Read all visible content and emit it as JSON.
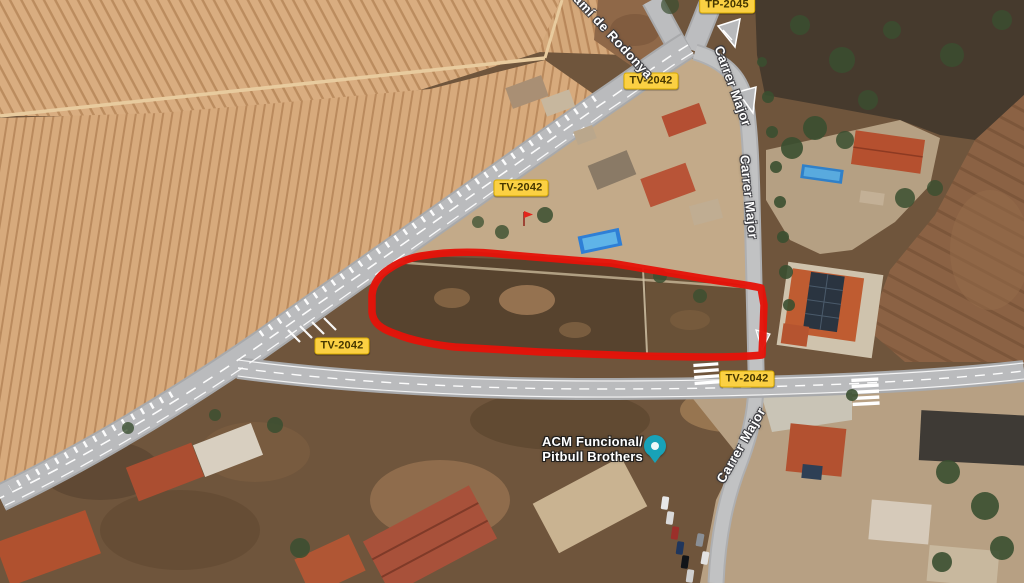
{
  "map": {
    "view": "satellite",
    "route_badges": [
      {
        "id": "tp-2045",
        "label": "TP-2045"
      },
      {
        "id": "tv-2042-top",
        "label": "TV-2042"
      },
      {
        "id": "tv-2042-mid",
        "label": "TV-2042"
      },
      {
        "id": "tv-2042-junction",
        "label": "TV-2042"
      },
      {
        "id": "tv-2042-east",
        "label": "TV-2042"
      }
    ],
    "road_labels": [
      {
        "id": "cami-de-rodonya",
        "label": "Camí de Rodonya"
      },
      {
        "id": "carrer-major-upper",
        "label": "Carrer Major"
      },
      {
        "id": "carrer-major-middle",
        "label": "Carrer Major"
      },
      {
        "id": "carrer-major-lower",
        "label": "Carrer Major"
      }
    ],
    "place": {
      "line1": "ACM Funcional/",
      "line2": "Pitbull Brothers"
    },
    "annotation": {
      "description": "hand-drawn red outline around vacant parcel",
      "color": "#e51309"
    },
    "colors": {
      "badge_bg": "#fbd043",
      "badge_text": "#463700",
      "marker_teal": "#18a2b8",
      "field_tan": "#d8ac7e",
      "furrow": "#b98a5c",
      "road_gray": "#b9babc",
      "scrub_dark": "#463a2d",
      "label_text": "#ffffff"
    }
  }
}
